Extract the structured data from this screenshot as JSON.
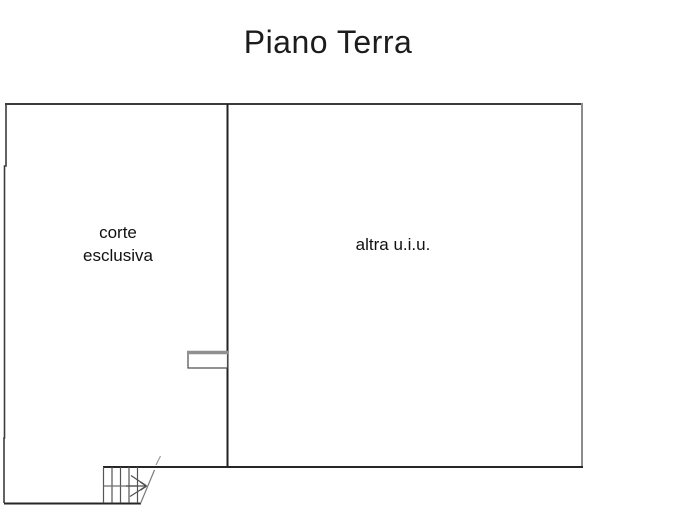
{
  "title": "Piano Terra",
  "plan": {
    "room_left": {
      "label_line1": "corte",
      "label_line2": "esclusiva"
    },
    "room_right": {
      "label": "altra u.i.u."
    },
    "symbols": {
      "staircase": "staircase-with-break-line",
      "direction_arrow": "stair-direction-arrow",
      "door_threshold": "door-threshold"
    },
    "colors": {
      "wall_dark": "#2e2e2e",
      "wall_light": "#8c8c8c",
      "stair_line": "#5a5a5a",
      "threshold_top": "#909090",
      "background": "#ffffff",
      "text": "#111111"
    }
  }
}
